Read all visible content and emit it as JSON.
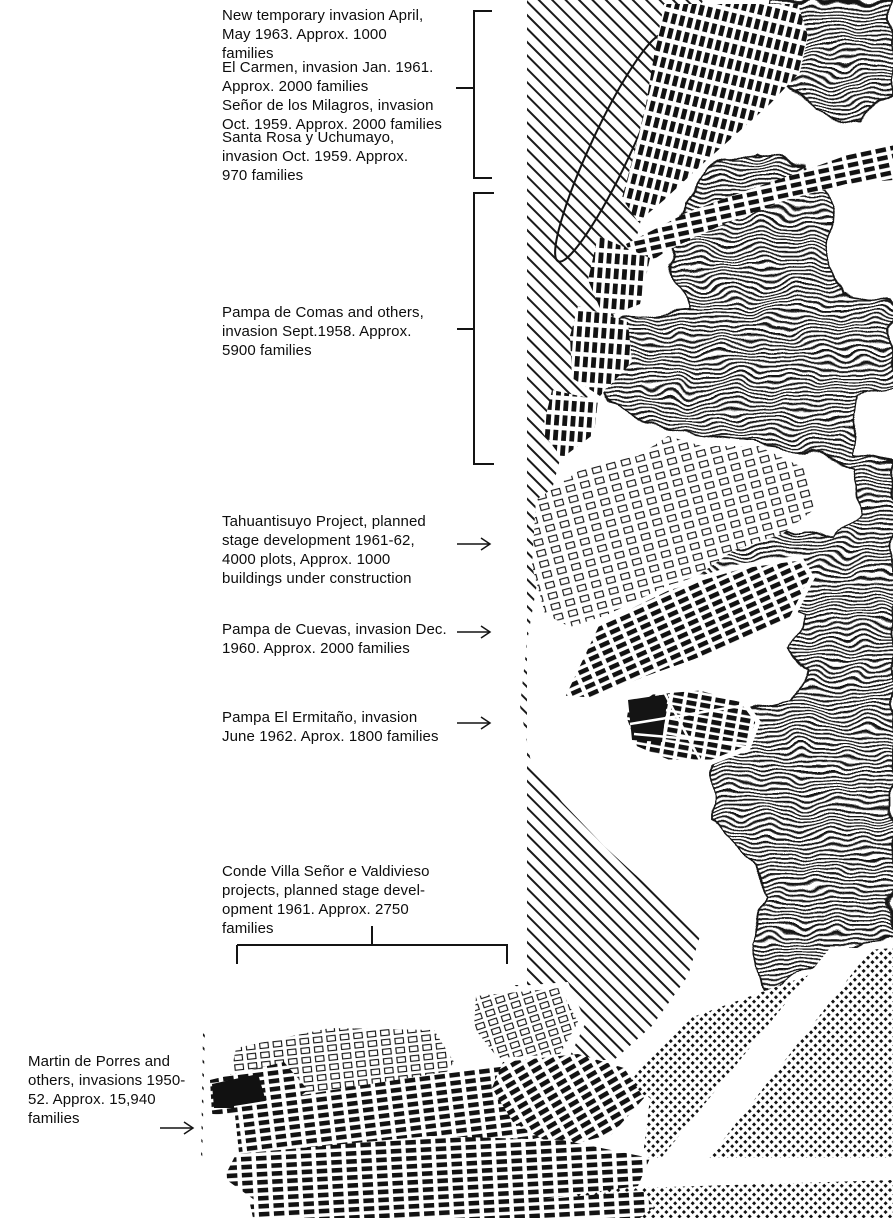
{
  "page": {
    "paper_color": "#ffffff",
    "ink_color": "#141414"
  },
  "annotations": {
    "labels": [
      {
        "id": "new-temporary",
        "lines": [
          "New temporary invasion April,",
          "May 1963. Approx. 1000",
          "families"
        ]
      },
      {
        "id": "el-carmen",
        "lines": [
          "El Carmen, invasion Jan. 1961.",
          "Approx. 2000 families"
        ]
      },
      {
        "id": "senor-de-los-milagros",
        "lines": [
          "Señor de los Milagros, invasion",
          "Oct. 1959. Approx. 2000 families"
        ]
      },
      {
        "id": "santa-rosa-y-uchumayo",
        "lines": [
          "Santa Rosa y Uchumayo,",
          "invasion Oct. 1959. Approx.",
          "970 families"
        ]
      },
      {
        "id": "pampa-de-comas",
        "lines": [
          "Pampa de Comas and others,",
          "invasion Sept.1958. Approx.",
          "5900 families"
        ]
      },
      {
        "id": "tahuantisuyo-project",
        "lines": [
          "Tahuantisuyo Project, planned",
          "stage development 1961-62,",
          "4000 plots, Approx. 1000",
          "buildings under construction"
        ]
      },
      {
        "id": "pampa-de-cuevas",
        "lines": [
          "Pampa de Cuevas, invasion Dec.",
          "1960. Approx. 2000 families"
        ]
      },
      {
        "id": "pampa-el-ermitano",
        "lines": [
          "Pampa El Ermitaño, invasion",
          "June 1962. Aprox. 1800 families"
        ]
      },
      {
        "id": "conde-villa-senor",
        "lines": [
          "Conde Villa Señor e Valdivieso",
          "projects, planned stage devel-",
          "opment 1961. Approx. 2750",
          "families"
        ]
      },
      {
        "id": "martin-de-porres",
        "lines": [
          "Martin de Porres and",
          "others, invasions 1950-",
          "52. Approx. 15,940",
          "families"
        ]
      }
    ]
  },
  "map": {
    "region_kinds": {
      "valley": "diagonal-hatch",
      "hills": "contour-texture",
      "built-up-city": "halftone-dots",
      "invasion-settlement": "solid-blocks",
      "planned-project": "outlined-blocks"
    }
  }
}
